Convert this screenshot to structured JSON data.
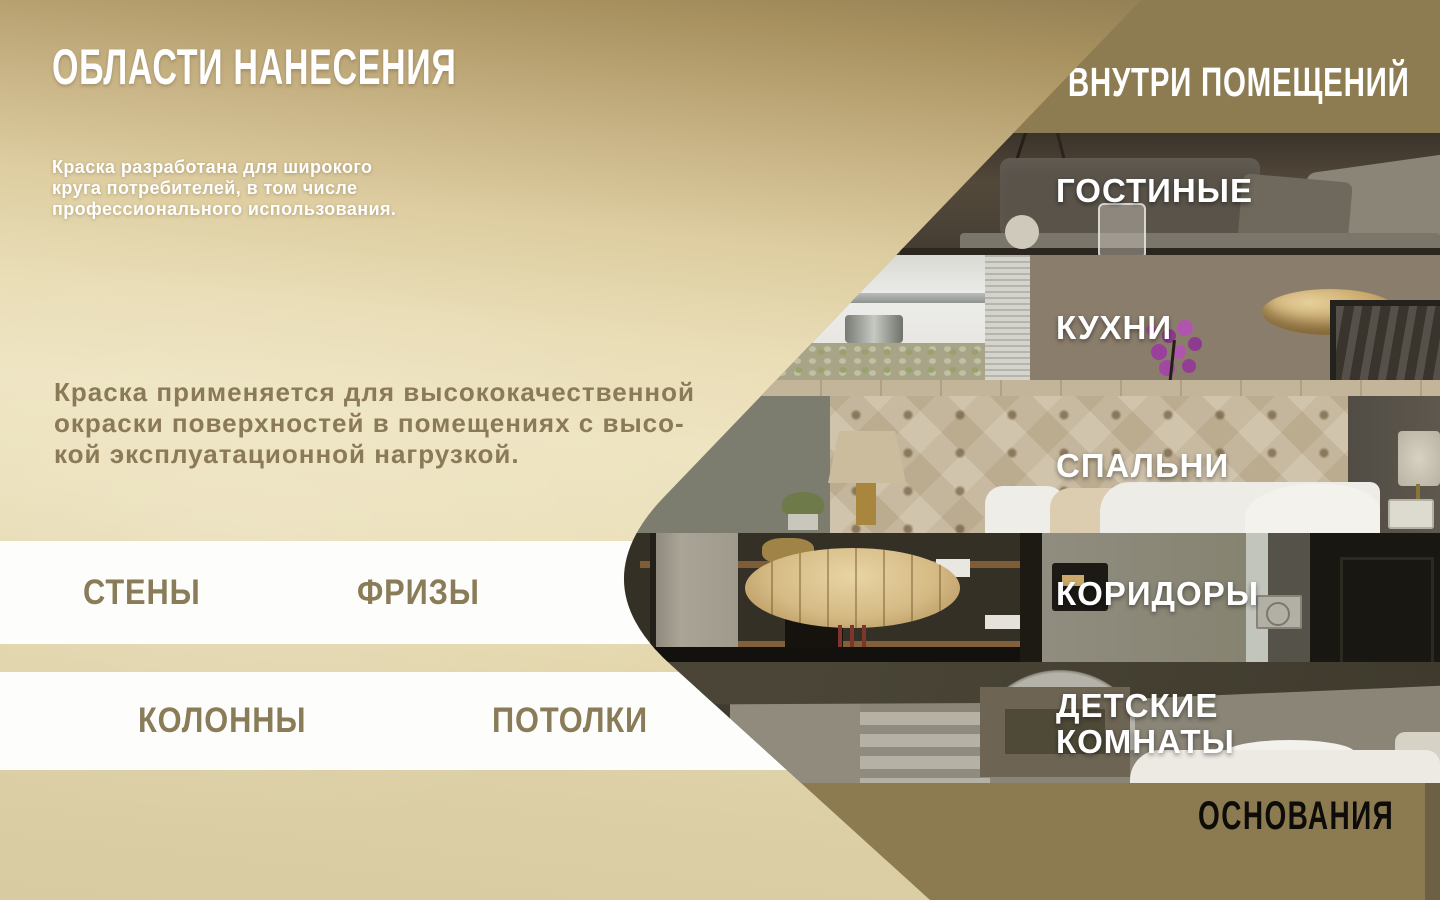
{
  "header": {
    "title": "ОБЛАСТИ НАНЕСЕНИЯ"
  },
  "intro": {
    "text": "Краска разработана для широкого\nкруга потребителей, в том числе\nпрофессионального использования."
  },
  "description": {
    "text": "Краска применяется для высококачественной\nокраски поверхностей в помещениях с высо-\nкой эксплуатационной нагрузкой."
  },
  "surface_bands": [
    {
      "items": [
        {
          "label": "СТЕНЫ"
        },
        {
          "label": "ФРИЗЫ"
        }
      ]
    },
    {
      "items": [
        {
          "label": "КОЛОННЫ"
        },
        {
          "label": "ПОТОЛКИ"
        }
      ]
    }
  ],
  "rooms_panel": {
    "header": "ВНУТРИ ПОМЕЩЕНИЙ",
    "rooms": [
      {
        "label": "ГОСТИНЫЕ"
      },
      {
        "label": "КУХНИ"
      },
      {
        "label": "СПАЛЬНИ"
      },
      {
        "label": "КОРИДОРЫ"
      },
      {
        "label": "ДЕТСКИЕ КОМНАТЫ"
      }
    ],
    "footer": "ОСНОВАНИЯ"
  },
  "colors": {
    "accent_olive": "#8d7b52",
    "text_olive": "#8a7a57",
    "background_cream": "#ece2bd",
    "dark_edge_strip": "#6d6044",
    "label_white": "#ffffff",
    "footer_text": "#0e0c08"
  }
}
